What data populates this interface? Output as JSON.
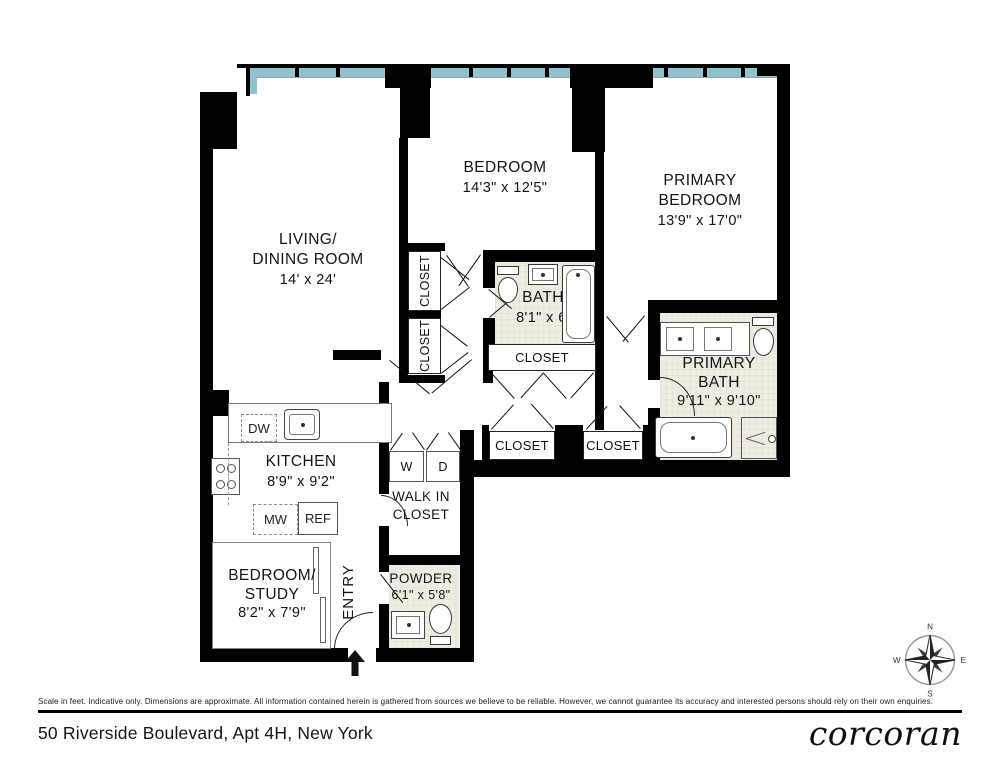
{
  "meta": {
    "address": "50 Riverside Boulevard, Apt 4H, New York",
    "brand": "corcoran",
    "disclaimer": "Scale in feet. Indicative only. Dimensions are approximate. All information contained herein is gathered from sources we believe to be reliable. However, we cannot guarantee its accuracy and interested persons should rely on their own enquiries."
  },
  "rooms": {
    "living_dining": {
      "line1": "LIVING/",
      "line2": "DINING ROOM",
      "dims": "14' x 24'"
    },
    "bedroom": {
      "line1": "BEDROOM",
      "dims": "14'3\" x 12'5\""
    },
    "primary_bedroom": {
      "line1": "PRIMARY",
      "line2": "BEDROOM",
      "dims": "13'9\" x 17'0\""
    },
    "bath": {
      "line1": "BATH",
      "dims": "8'1\" x 6'"
    },
    "primary_bath": {
      "line1": "PRIMARY",
      "line2": "BATH",
      "dims": "9'11\" x 9'10\""
    },
    "kitchen": {
      "line1": "KITCHEN",
      "dims": "8'9\" x 9'2\""
    },
    "bedroom_study": {
      "line1": "BEDROOM/",
      "line2": "STUDY",
      "dims": "8'2\" x 7'9\""
    },
    "powder": {
      "line1": "POWDER",
      "dims": "6'1\" x 5'8\""
    },
    "walk_in_closet": {
      "line1": "WALK IN",
      "line2": "CLOSET"
    },
    "entry": {
      "label": "ENTRY"
    }
  },
  "labels": {
    "closet": "CLOSET",
    "washer": "W",
    "dryer": "D",
    "dishwasher": "DW",
    "microwave": "MW",
    "refrigerator": "REF"
  },
  "compass": {
    "north": "N",
    "east": "E",
    "south": "S",
    "west": "W"
  },
  "colors": {
    "wall": "#000000",
    "window": "#8fc2cc",
    "bath_floor": "#f0ece1"
  }
}
